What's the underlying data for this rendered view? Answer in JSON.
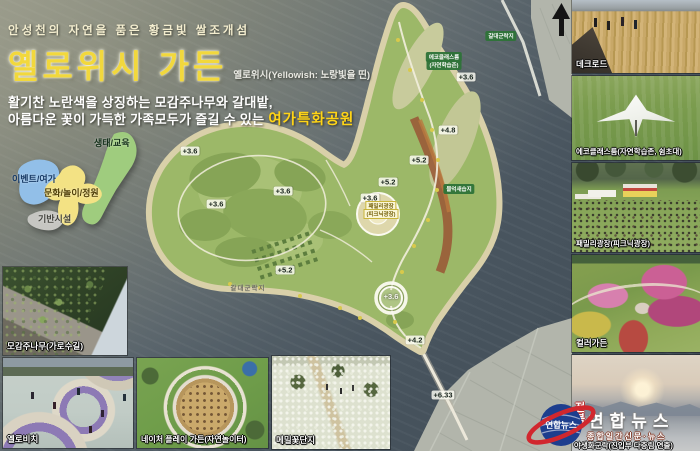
{
  "header": {
    "tagline": "안성천의 자연을 품은 황금빛 쌀조개섬",
    "title": "옐로위시 가든",
    "title_sub": "옐로위시(Yellowish: 노랑빛을 띤)",
    "desc_line1": "활기찬 노란색을 상징하는 모감주나무와 갈대밭,",
    "desc_line2_prefix": "아름다운 꽃이 가득한 가족모두가 즐길 수 있는 ",
    "desc_highlight": "여가특화공원"
  },
  "concept_legend": {
    "items": [
      {
        "label": "생태/교육",
        "color": "#9fcc7e"
      },
      {
        "label": "이벤트/여가",
        "color": "#92bfe8"
      },
      {
        "label": "문화/놀이/정원",
        "color": "#f3e284"
      },
      {
        "label": "기반시설",
        "color": "#c6c6c2"
      }
    ]
  },
  "map": {
    "area_labels": [
      {
        "text": "갈대군락지",
        "x": 501,
        "y": 36,
        "style": "green"
      },
      {
        "text": "에코클래스룸",
        "x": 444,
        "y": 57,
        "style": "green"
      },
      {
        "text": "(자연학습존)",
        "x": 444,
        "y": 65,
        "style": "green"
      },
      {
        "text": "물억새습지",
        "x": 459,
        "y": 189,
        "style": "green"
      },
      {
        "text": "갈대군락지",
        "x": 248,
        "y": 287,
        "style": "gray"
      },
      {
        "text": "패밀리광장",
        "x": 381,
        "y": 206,
        "style": "yellow"
      },
      {
        "text": "(피크닉광장)",
        "x": 381,
        "y": 214,
        "style": "yellow"
      }
    ],
    "elevation_markers": [
      {
        "value": "+3.6",
        "x": 466,
        "y": 77
      },
      {
        "value": "+4.8",
        "x": 448,
        "y": 130
      },
      {
        "value": "+5.2",
        "x": 419,
        "y": 160
      },
      {
        "value": "+5.2",
        "x": 388,
        "y": 182
      },
      {
        "value": "+3.6",
        "x": 370,
        "y": 198
      },
      {
        "value": "+3.6",
        "x": 190,
        "y": 151
      },
      {
        "value": "+3.6",
        "x": 216,
        "y": 204
      },
      {
        "value": "+3.6",
        "x": 283,
        "y": 191
      },
      {
        "value": "+5.2",
        "x": 285,
        "y": 270
      },
      {
        "value": "+3.6",
        "x": 391,
        "y": 298,
        "circled": true
      },
      {
        "value": "+4.2",
        "x": 415,
        "y": 340
      },
      {
        "value": "+6.33",
        "x": 443,
        "y": 395
      }
    ]
  },
  "photos": {
    "deck_road": "데크로드",
    "eco_classroom": "에코클래스룸(자연학습존, 쉼초대)",
    "family_plaza": "패밀리광장(피크닉광장)",
    "color_garden": "컬러가든",
    "tree_street": "모감주나무(가로수길)",
    "yellow_beach": "옐로비치",
    "nature_play": "네이처 플레이 가든(자연놀이터)",
    "buckwheat_field": "메밀꽃단지"
  },
  "watermark": {
    "region": "전북",
    "brand": "연합뉴스",
    "subtitle": "종합일간신문·뉴스",
    "caption": "야생화군락(진입부 다층림 연출)",
    "logo_blue": "#1d3e8e",
    "logo_red": "#d1272e"
  }
}
